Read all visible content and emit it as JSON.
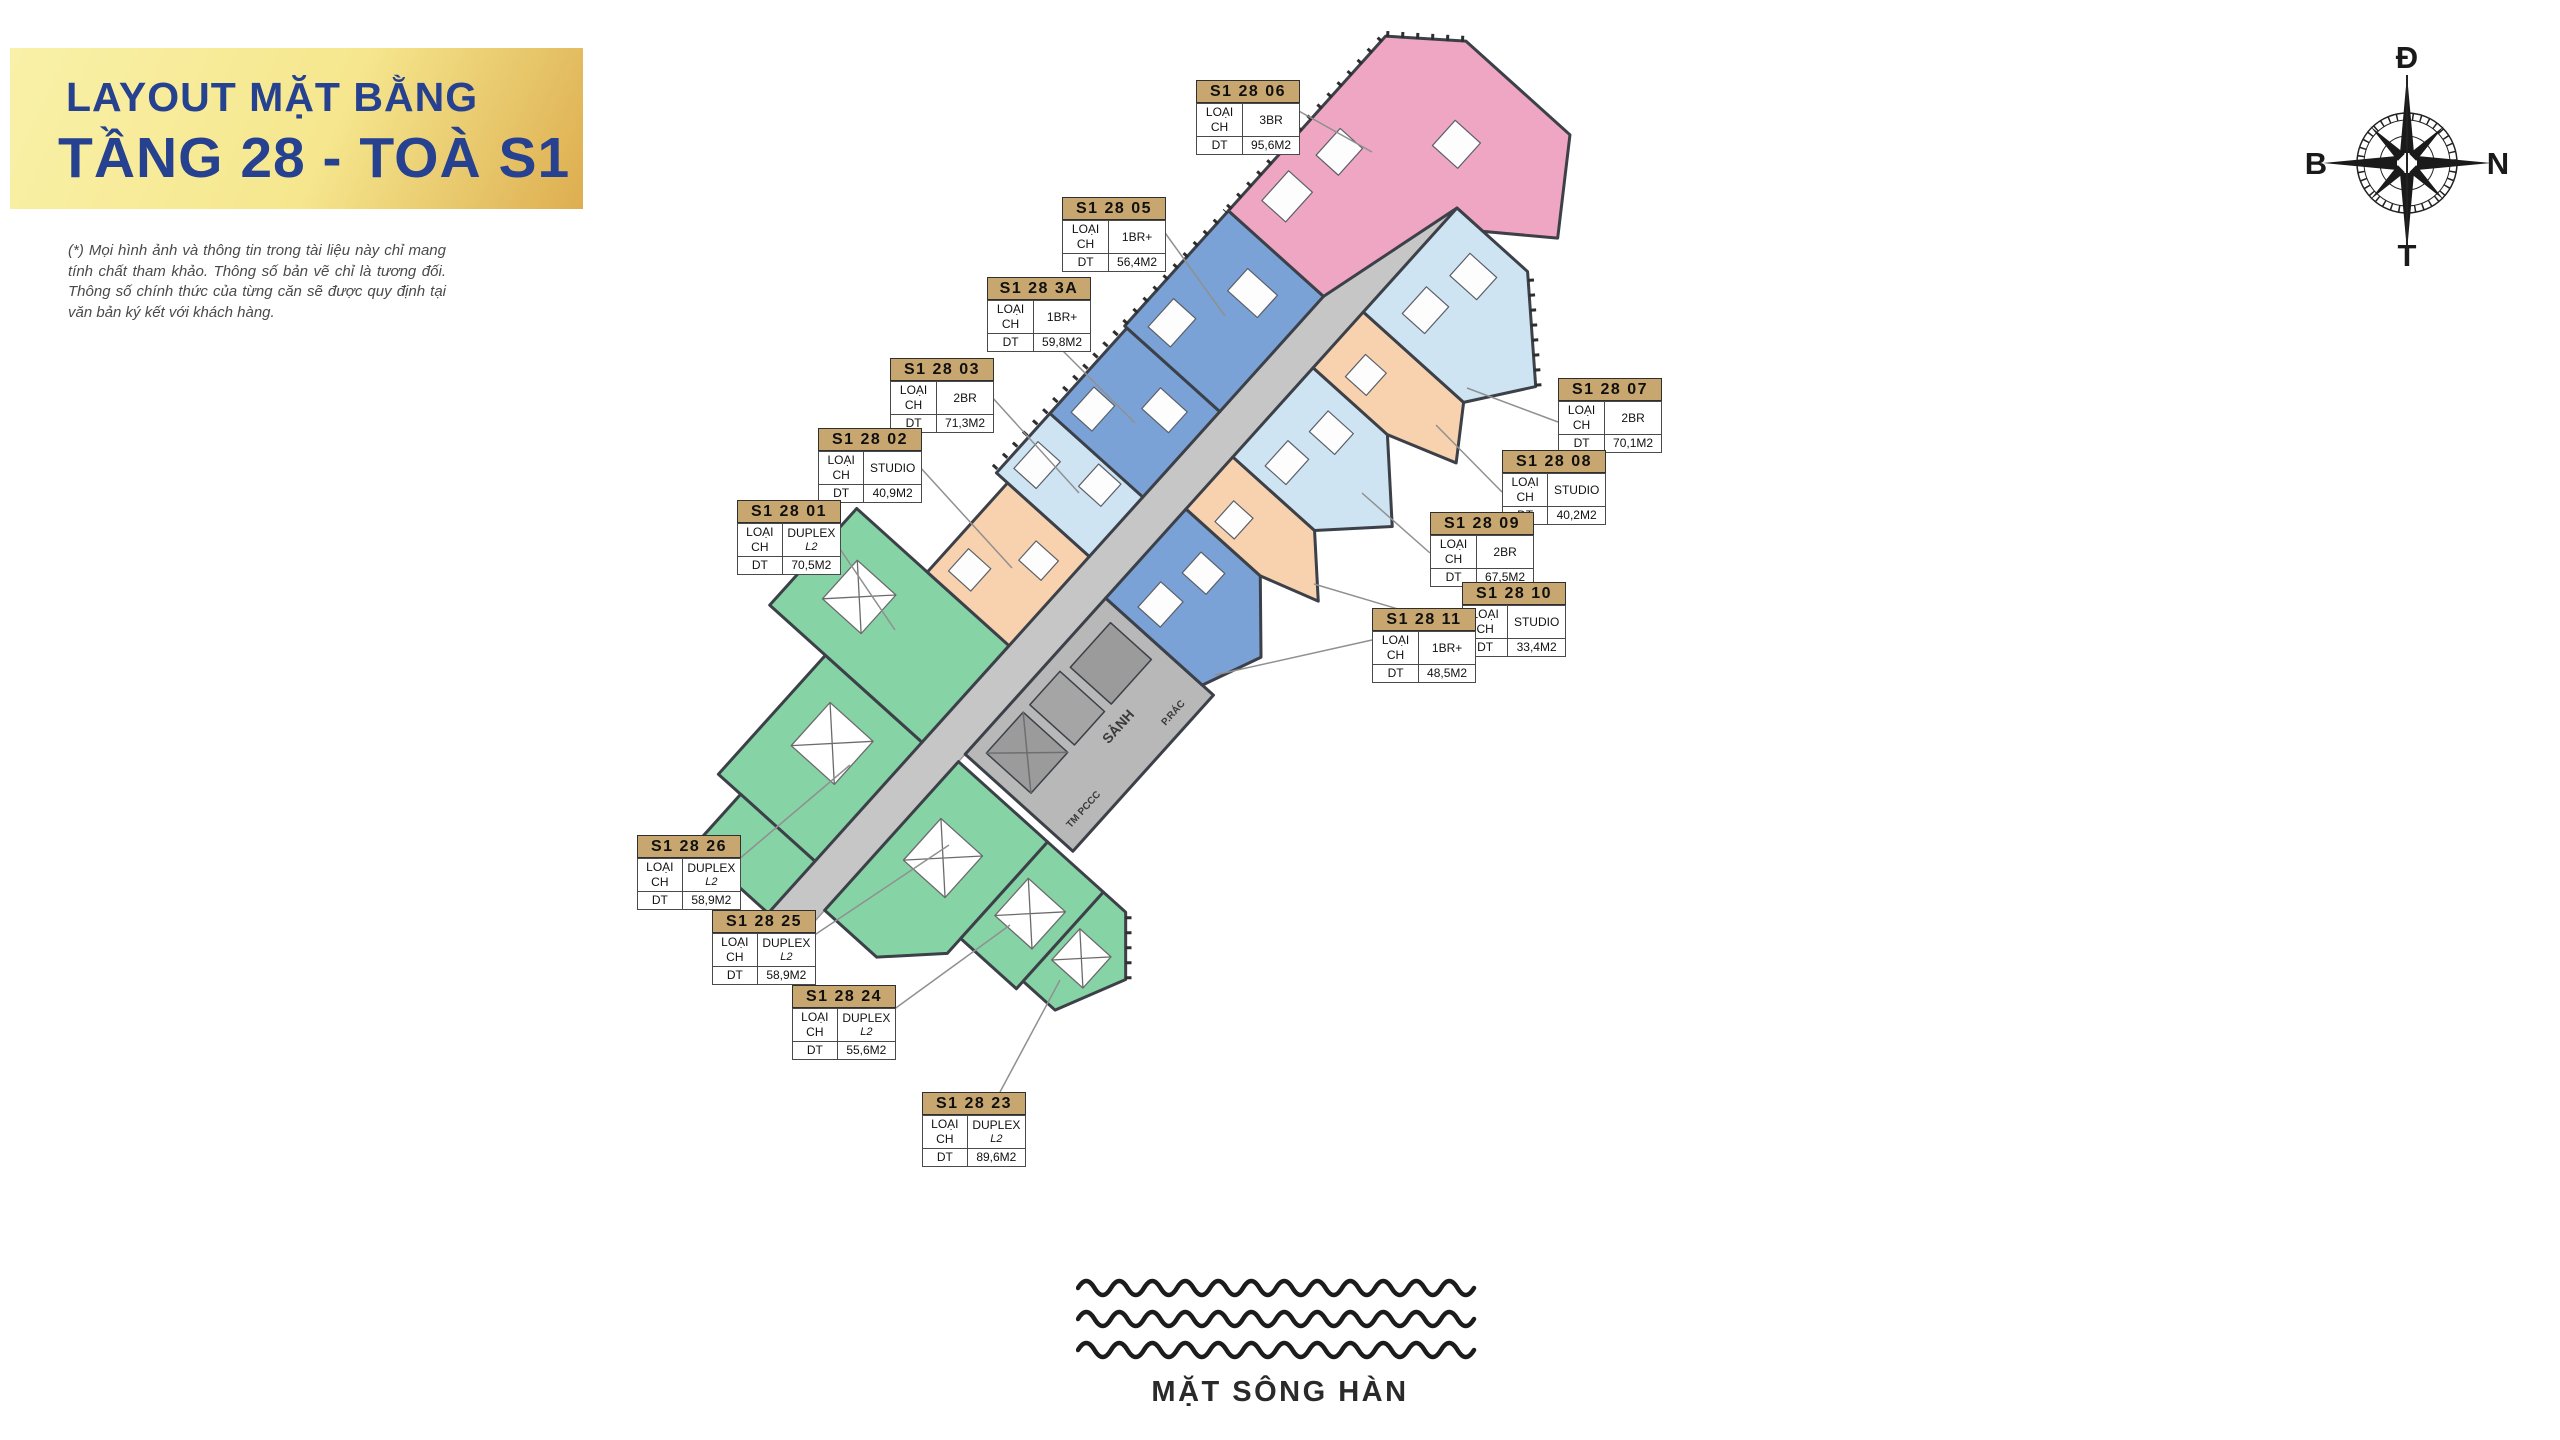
{
  "title": {
    "line1": "LAYOUT MẶT BẰNG",
    "line2": "TẦNG 28 - TOÀ S1"
  },
  "disclaimer": "(*) Mọi hình ảnh và thông tin trong tài liệu này chỉ mang tính chất tham khảo. Thông số bản vẽ chỉ là tương đối. Thông số chính thức của từng căn sẽ được quy định tại văn bản ký kết với khách hàng.",
  "compass": {
    "top": "Đ",
    "right": "N",
    "bottom": "T",
    "left": "B"
  },
  "river_label": "MẶT SÔNG HÀN",
  "fields": {
    "type_label": "LOẠI CH",
    "area_label": "DT"
  },
  "plan": {
    "lobby_label": "SẢNH",
    "fire_label": "TM PCCC",
    "trash_label": "P.RÁC",
    "palette": {
      "blue": "#7aa2d6",
      "pale": "#cfe4f2",
      "pink": "#efa6c3",
      "peach": "#f8d2ae",
      "green": "#86d3a6",
      "corridor": "#c6c6c6",
      "core": "#b8b8b8"
    }
  },
  "units": [
    {
      "id": "S1 28 06",
      "type": "3BR",
      "subtype": "",
      "area": "95,6M2",
      "x": 1196,
      "y": 80,
      "leader": [
        1297,
        110,
        1372,
        152
      ]
    },
    {
      "id": "S1 28 05",
      "type": "1BR+",
      "subtype": "",
      "area": "56,4M2",
      "x": 1062,
      "y": 197,
      "leader": [
        1163,
        230,
        1225,
        316
      ]
    },
    {
      "id": "S1 28 3A",
      "type": "1BR+",
      "subtype": "",
      "area": "59,8M2",
      "x": 987,
      "y": 277,
      "leader": [
        1056,
        344,
        1135,
        423
      ]
    },
    {
      "id": "S1 28 03",
      "type": "2BR",
      "subtype": "",
      "area": "71,3M2",
      "x": 890,
      "y": 358,
      "leader": [
        991,
        396,
        1079,
        493
      ]
    },
    {
      "id": "S1 28 02",
      "type": "STUDIO",
      "subtype": "",
      "area": "40,9M2",
      "x": 818,
      "y": 428,
      "leader": [
        919,
        466,
        1012,
        568
      ]
    },
    {
      "id": "S1 28 01",
      "type": "DUPLEX",
      "subtype": "L2",
      "area": "70,5M2",
      "x": 737,
      "y": 500,
      "leader": [
        838,
        546,
        895,
        630
      ]
    },
    {
      "id": "S1 28 07",
      "type": "2BR",
      "subtype": "",
      "area": "70,1M2",
      "x": 1558,
      "y": 378,
      "leader": [
        1558,
        422,
        1467,
        388
      ]
    },
    {
      "id": "S1 28 08",
      "type": "STUDIO",
      "subtype": "",
      "area": "40,2M2",
      "x": 1502,
      "y": 450,
      "leader": [
        1502,
        492,
        1436,
        425
      ]
    },
    {
      "id": "S1 28 09",
      "type": "2BR",
      "subtype": "",
      "area": "67,5M2",
      "x": 1430,
      "y": 512,
      "leader": [
        1430,
        553,
        1362,
        493
      ]
    },
    {
      "id": "S1 28 10",
      "type": "STUDIO",
      "subtype": "",
      "area": "33,4M2",
      "x": 1462,
      "y": 582,
      "leader": [
        1462,
        628,
        1314,
        584
      ]
    },
    {
      "id": "S1 28 11",
      "type": "1BR+",
      "subtype": "",
      "area": "48,5M2",
      "x": 1372,
      "y": 608,
      "leader": [
        1372,
        640,
        1215,
        675
      ]
    },
    {
      "id": "S1 28 26",
      "type": "DUPLEX",
      "subtype": "L2",
      "area": "58,9M2",
      "x": 637,
      "y": 835,
      "leader": [
        738,
        860,
        850,
        765
      ]
    },
    {
      "id": "S1 28 25",
      "type": "DUPLEX",
      "subtype": "L2",
      "area": "58,9M2",
      "x": 712,
      "y": 910,
      "leader": [
        813,
        936,
        949,
        845
      ]
    },
    {
      "id": "S1 28 24",
      "type": "DUPLEX",
      "subtype": "L2",
      "area": "55,6M2",
      "x": 792,
      "y": 985,
      "leader": [
        893,
        1010,
        1010,
        925
      ]
    },
    {
      "id": "S1 28 23",
      "type": "DUPLEX",
      "subtype": "L2",
      "area": "89,6M2",
      "x": 922,
      "y": 1092,
      "leader": [
        1000,
        1092,
        1060,
        980
      ]
    }
  ]
}
